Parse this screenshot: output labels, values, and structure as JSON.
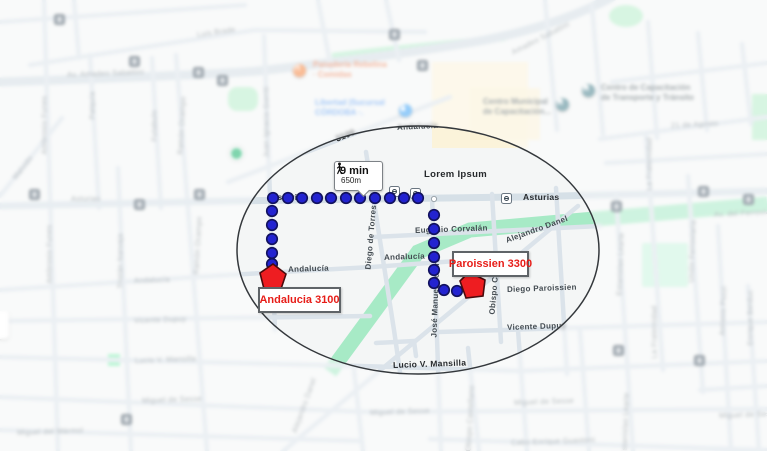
{
  "route": {
    "callout": {
      "duration": "9 min",
      "distance": "650m",
      "icon": "walking-person-icon"
    },
    "origin_box": {
      "label": "Andalucia 3100",
      "x": 258,
      "y": 287,
      "w": 79,
      "h": 22
    },
    "destination_box": {
      "label": "Paroissien 3300",
      "x": 452,
      "y": 251,
      "w": 73,
      "h": 22
    },
    "dot_color": "#2323d0",
    "dot_ring_color": "#12125e",
    "marker_color": "#ee1d21",
    "marker_ring_color": "#4a0b0d",
    "path": {
      "horizontal_dots_y": 198,
      "horizontal_dots_x": [
        273,
        288,
        302,
        317,
        331,
        346,
        360,
        375,
        390,
        404,
        418
      ],
      "left_vertical_x": 272,
      "left_vertical_ys": [
        211,
        225,
        239,
        253,
        264
      ],
      "right_vertical_x": 434,
      "right_vertical_ys": [
        215,
        229,
        243,
        257,
        270,
        283
      ],
      "tail_dots": [
        [
          444,
          290
        ],
        [
          457,
          291
        ]
      ],
      "white_vertex": [
        434,
        199
      ],
      "origin_marker_points": "273,264 286,274 281,289 264,289 260,273",
      "destination_marker_points": "469,272 485,280 483,296 466,298 460,281"
    }
  },
  "map": {
    "highlight_ellipse": {
      "cx": 418,
      "cy": 250,
      "rx": 181,
      "ry": 124,
      "stroke": "#34383c"
    },
    "street_labels": [
      {
        "t": "Luis Brade",
        "x": 197,
        "y": 30,
        "r": -8,
        "c": "st"
      },
      {
        "t": "Av. Amadeo Sabattini",
        "x": 67,
        "y": 70,
        "r": -2,
        "c": "st"
      },
      {
        "t": "Amadeo Sabattini",
        "x": 512,
        "y": 48,
        "r": -27,
        "c": "st"
      },
      {
        "t": "Patquía",
        "x": 92,
        "y": 115,
        "r": -90,
        "c": "st"
      },
      {
        "t": "Futabulo",
        "x": 154,
        "y": 137,
        "r": -90,
        "c": "st"
      },
      {
        "t": "Ramón Ocampo",
        "x": 180,
        "y": 150,
        "r": -87,
        "c": "st"
      },
      {
        "t": "Ramón Ocampo",
        "x": 196,
        "y": 270,
        "r": -87,
        "c": "st"
      },
      {
        "t": "Ambrosio Funes",
        "x": 44,
        "y": 150,
        "r": -90,
        "c": "st"
      },
      {
        "t": "Ambrosio Funes",
        "x": 49,
        "y": 279,
        "r": -90,
        "c": "st"
      },
      {
        "t": "Tristán Narvaja",
        "x": 120,
        "y": 284,
        "r": -90,
        "c": "st"
      },
      {
        "t": "Juan Ignacio Gorriti",
        "x": 266,
        "y": 153,
        "r": -90,
        "c": "st"
      },
      {
        "t": "Malvido",
        "x": 14,
        "y": 174,
        "r": -52,
        "c": "st"
      },
      {
        "t": "Asturias",
        "x": 71,
        "y": 194,
        "r": 0,
        "c": "st"
      },
      {
        "t": "Asturias",
        "x": 271,
        "y": 192,
        "r": 0,
        "c": "stB"
      },
      {
        "t": "Asturias",
        "x": 523,
        "y": 192,
        "r": 0,
        "c": "stB"
      },
      {
        "t": "Lorem Ipsum",
        "x": 424,
        "y": 169,
        "r": 0,
        "c": "stB big"
      },
      {
        "t": "Eugenio Corvalán",
        "x": 415,
        "y": 226,
        "r": -2,
        "c": "stD"
      },
      {
        "t": "Andalucía",
        "x": 397,
        "y": 123,
        "r": -3,
        "c": "stD"
      },
      {
        "t": "3100",
        "x": 336,
        "y": 134,
        "r": -22,
        "c": "stB"
      },
      {
        "t": "Andalucía",
        "x": 288,
        "y": 265,
        "r": -2,
        "c": "stD"
      },
      {
        "t": "Andalucía",
        "x": 384,
        "y": 253,
        "r": -2,
        "c": "stD"
      },
      {
        "t": "Andalucía",
        "x": 134,
        "y": 276,
        "r": -2,
        "c": "st"
      },
      {
        "t": "Diego de Torres",
        "x": 368,
        "y": 265,
        "r": -85,
        "c": "stD"
      },
      {
        "t": "José Manuel Solares",
        "x": 434,
        "y": 333,
        "r": -88,
        "c": "stD"
      },
      {
        "t": "Obispo C",
        "x": 492,
        "y": 310,
        "r": -85,
        "c": "stD"
      },
      {
        "t": "Obispo Castellano",
        "x": 468,
        "y": 447,
        "r": -87,
        "c": "st"
      },
      {
        "t": "Alejandro Danel",
        "x": 506,
        "y": 236,
        "r": -20,
        "c": "stD"
      },
      {
        "t": "Alejandro Danel",
        "x": 294,
        "y": 428,
        "r": -70,
        "c": "st"
      },
      {
        "t": "Diego Paroissien",
        "x": 507,
        "y": 285,
        "r": -2,
        "c": "stD"
      },
      {
        "t": "Vicente Dupuy",
        "x": 507,
        "y": 323,
        "r": -2,
        "c": "stD"
      },
      {
        "t": "Vicente Dupuy",
        "x": 134,
        "y": 316,
        "r": -2,
        "c": "st"
      },
      {
        "t": "Lucio V. Mansilla",
        "x": 393,
        "y": 360,
        "r": -2,
        "c": "stB"
      },
      {
        "t": "Lucio V. Mansilla",
        "x": 135,
        "y": 356,
        "r": -2,
        "c": "st"
      },
      {
        "t": "Miguel de Sesse",
        "x": 142,
        "y": 396,
        "r": -2,
        "c": "st"
      },
      {
        "t": "Miguel de Sesse",
        "x": 370,
        "y": 408,
        "r": -2,
        "c": "st"
      },
      {
        "t": "Miguel de Sesse",
        "x": 514,
        "y": 398,
        "r": -2,
        "c": "st"
      },
      {
        "t": "Miguel de Sesse",
        "x": 719,
        "y": 411,
        "r": -2,
        "c": "st"
      },
      {
        "t": "Miguel del Mármol",
        "x": 17,
        "y": 428,
        "r": -2,
        "c": "st"
      },
      {
        "t": "Cabo Enrique Guastoni",
        "x": 511,
        "y": 438,
        "r": -2,
        "c": "st"
      },
      {
        "t": "21 de Agosto",
        "x": 671,
        "y": 121,
        "r": -3,
        "c": "st"
      },
      {
        "t": "Av. del Ferroviario",
        "x": 714,
        "y": 210,
        "r": -3,
        "c": "st"
      },
      {
        "t": "La Fraternidad",
        "x": 649,
        "y": 186,
        "r": -90,
        "c": "st"
      },
      {
        "t": "La Fraternidad",
        "x": 654,
        "y": 354,
        "r": -90,
        "c": "st"
      },
      {
        "t": "Estanislao Learte",
        "x": 619,
        "y": 291,
        "r": -88,
        "c": "st"
      },
      {
        "t": "Estanislao Learte",
        "x": 624,
        "y": 451,
        "r": -88,
        "c": "st"
      },
      {
        "t": "Unión Ferroviaria",
        "x": 691,
        "y": 278,
        "r": -88,
        "c": "st"
      },
      {
        "t": "Antonio Pozzi",
        "x": 722,
        "y": 331,
        "r": -88,
        "c": "st"
      },
      {
        "t": "Enrique Berduc",
        "x": 750,
        "y": 341,
        "r": -90,
        "c": "st"
      }
    ],
    "poi_labels": [
      {
        "lines": [
          "Panadería Rebelina",
          "· Comidas"
        ],
        "x": 313,
        "y": 60,
        "color": "#ec7e52",
        "icon": "restaurant-icon",
        "ix": 293,
        "iy": 64,
        "ibg": "#f5853f"
      },
      {
        "lines": [
          "Libertad |Sucursal",
          "CÓRDOBA ·."
        ],
        "x": 315,
        "y": 98,
        "color": "#5d9df2",
        "icon": "store-icon",
        "ix": 399,
        "iy": 104,
        "ibg": "#3fa4f6"
      },
      {
        "lines": [
          "Centro Municipal",
          "de Capacitación..."
        ],
        "x": 483,
        "y": 97,
        "color": "#5f6b70",
        "icon": "building-icon",
        "ix": 556,
        "iy": 98,
        "ibg": "#47808d"
      },
      {
        "lines": [
          "Centro de Capacitación",
          "de Transporte y Tránsito"
        ],
        "x": 601,
        "y": 83,
        "color": "#5f6b70",
        "icon": "building-icon",
        "ix": 582,
        "iy": 84,
        "ibg": "#47808d"
      }
    ],
    "park_poi": [
      229,
      146
    ],
    "transit_stops_dark": [
      [
        58,
        18
      ],
      [
        133,
        60
      ],
      [
        197,
        71
      ],
      [
        221,
        79
      ],
      [
        393,
        33
      ],
      [
        421,
        64
      ],
      [
        33,
        193
      ],
      [
        138,
        203
      ],
      [
        198,
        193
      ],
      [
        615,
        205
      ],
      [
        702,
        190
      ],
      [
        747,
        198
      ],
      [
        125,
        418
      ],
      [
        617,
        349
      ],
      [
        698,
        359
      ]
    ],
    "transit_stops_light": [
      [
        393,
        190
      ],
      [
        414,
        192
      ],
      [
        505,
        197
      ]
    ]
  }
}
